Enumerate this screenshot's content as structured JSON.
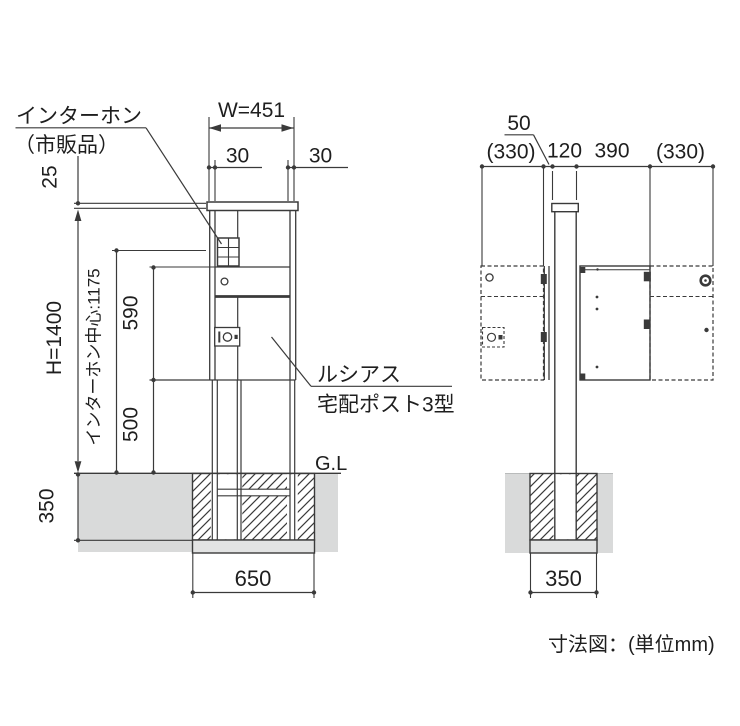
{
  "front_view": {
    "intercom_label": {
      "line1": "インターホン",
      "line2": "（市販品）"
    },
    "product_label": {
      "line1": "ルシアス",
      "line2": "宅配ポスト3型"
    },
    "dims": {
      "top_offset": "25",
      "height": "H=1400",
      "intercom_center": "インターホン中心:1175",
      "upper_section": "590",
      "lower_section": "500",
      "overall_width": "W=451",
      "side_margin_left": "30",
      "side_margin_right": "30",
      "embed_depth": "350",
      "foundation_width": "650"
    },
    "ground_line": "G.L"
  },
  "side_view": {
    "dims": {
      "bracket_offset": "50",
      "door_swing_left": "(330)",
      "post_depth": "120",
      "body_depth": "390",
      "door_swing_right": "(330)",
      "foundation_width": "350"
    }
  },
  "footer": {
    "caption": "寸法図：(単位mm)"
  },
  "colors": {
    "line": "#3a3a3a",
    "soil": "#d9dada",
    "slab": "#e2e3e3"
  }
}
